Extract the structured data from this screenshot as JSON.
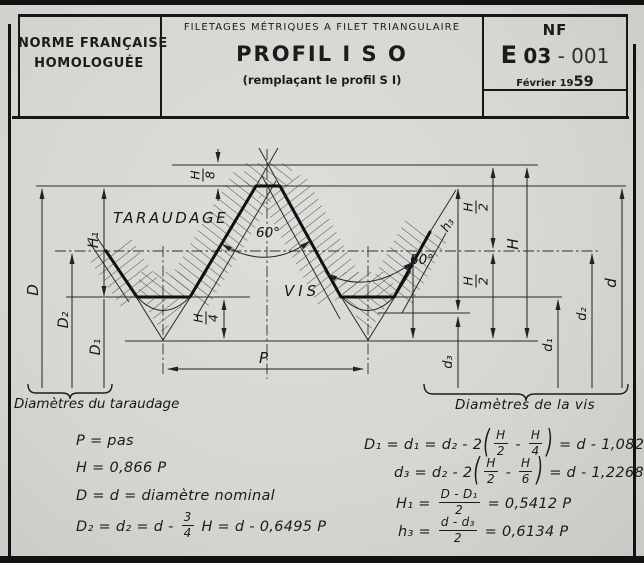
{
  "colors": {
    "paper": "#d7d6d2",
    "ink": "#1b1b1b"
  },
  "header": {
    "left_line1": "NORME FRANÇAISE",
    "left_line2": "HOMOLOGUÉE",
    "center_top": "FILETAGES MÉTRIQUES A FILET TRIANGULAIRE",
    "center_title": "PROFIL I S O",
    "center_sub": "(remplaçant le profil S I)",
    "nf_label": "NF",
    "code_prefix": "E",
    "code_number": "03",
    "code_suffix": "- 001",
    "date_prefix": "Février 19",
    "date_year": "59"
  },
  "diagram": {
    "label_taraudage": "TARAUDAGE",
    "label_vis": "VIS",
    "angle_left": "60°",
    "angle_right": "60°",
    "dim_P": "P",
    "dim_H": "H",
    "dim_H1": "H₁",
    "dim_h3": "h₃",
    "dim_D": "D",
    "dim_D2": "D₂",
    "dim_D1": "D₁",
    "dim_d": "d",
    "dim_d2": "d₂",
    "dim_d1": "d₁",
    "dim_d3": "d₃",
    "frac_h8": {
      "num": "H",
      "den": "8"
    },
    "frac_h4": {
      "num": "H",
      "den": "4"
    },
    "frac_h2_upper": {
      "num": "H",
      "den": "2"
    },
    "frac_h2_lower": {
      "num": "H",
      "den": "2"
    },
    "brace_left_label": "Diamètres du taraudage",
    "brace_right_label": "Diamètres de la vis"
  },
  "formulas": {
    "left": [
      {
        "tokens": [
          {
            "t": "txt",
            "v": "P = pas"
          }
        ]
      },
      {
        "tokens": [
          {
            "t": "txt",
            "v": "H = 0,866 P"
          }
        ]
      },
      {
        "tokens": [
          {
            "t": "txt",
            "v": "D = d = diamètre nominal"
          }
        ]
      },
      {
        "tokens": [
          {
            "t": "txt",
            "v": "D₂ = d₂ = d - "
          },
          {
            "t": "frac",
            "num": "3",
            "den": "4"
          },
          {
            "t": "txt",
            "v": " H = d - 0,6495 P"
          }
        ]
      }
    ],
    "right": [
      {
        "tokens": [
          {
            "t": "txt",
            "v": "D₁ = d₁ = d₂ - 2"
          },
          {
            "t": "par",
            "v": "("
          },
          {
            "t": "frac",
            "num": "H",
            "den": "2"
          },
          {
            "t": "txt",
            "v": " - "
          },
          {
            "t": "frac",
            "num": "H",
            "den": "4"
          },
          {
            "t": "par",
            "v": ")"
          },
          {
            "t": "txt",
            "v": " = d - 1,0825 P"
          }
        ]
      },
      {
        "tokens": [
          {
            "t": "txt",
            "v": "d₃ = d₂ - 2"
          },
          {
            "t": "par",
            "v": "("
          },
          {
            "t": "frac",
            "num": "H",
            "den": "2"
          },
          {
            "t": "txt",
            "v": " - "
          },
          {
            "t": "frac",
            "num": "H",
            "den": "6"
          },
          {
            "t": "par",
            "v": ")"
          },
          {
            "t": "txt",
            "v": " = d - 1,2268 P"
          }
        ]
      },
      {
        "tokens": [
          {
            "t": "txt",
            "v": "H₁ =  "
          },
          {
            "t": "frac",
            "num": "D - D₁",
            "den": "2"
          },
          {
            "t": "txt",
            "v": " = 0,5412 P"
          }
        ]
      },
      {
        "tokens": [
          {
            "t": "txt",
            "v": "h₃ =  "
          },
          {
            "t": "frac",
            "num": "d - d₃",
            "den": "2"
          },
          {
            "t": "txt",
            "v": " = 0,6134 P"
          }
        ]
      }
    ]
  }
}
